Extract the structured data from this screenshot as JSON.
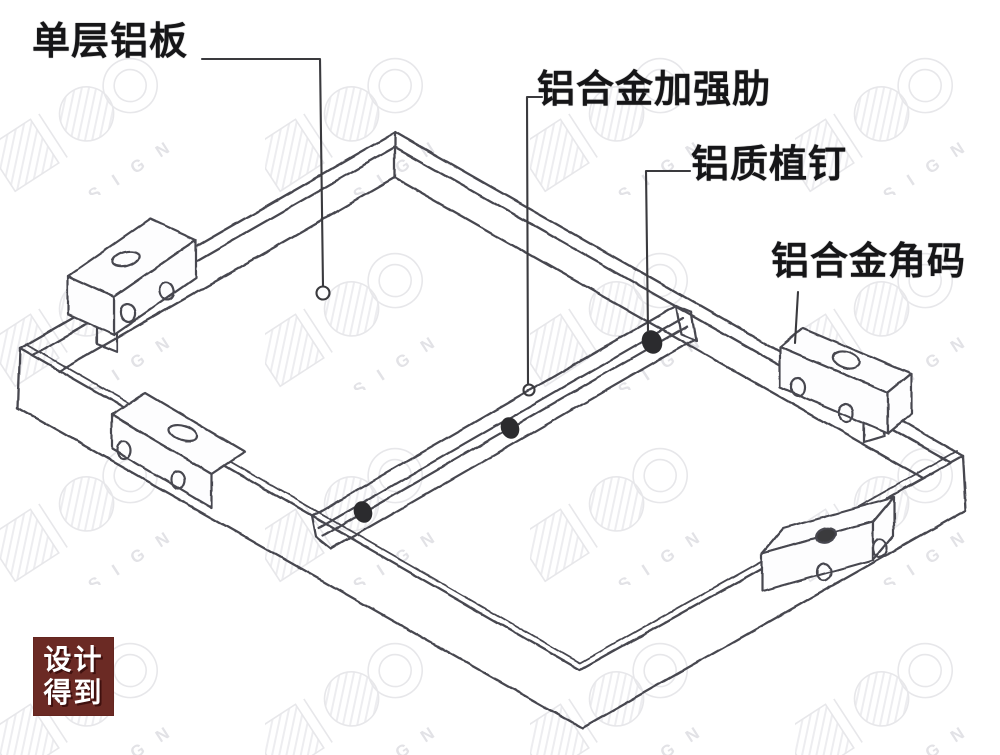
{
  "labels": [
    {
      "id": "single-layer-aluminum-panel",
      "text": "单层铝板"
    },
    {
      "id": "aluminum-alloy-stiffener-rib",
      "text": "铝合金加强肋"
    },
    {
      "id": "aluminum-stud",
      "text": "铝质植钉"
    },
    {
      "id": "aluminum-alloy-corner-bracket",
      "text": "铝合金角码"
    }
  ],
  "watermark": {
    "text": "DESIGN"
  },
  "logo": {
    "line1": "设计",
    "line2": "得到",
    "background": "#6B2A24",
    "text_color": "#FFFFFF"
  },
  "colors": {
    "background": "#FDFDFD",
    "sketch_line": "#474750",
    "leader_line": "#3A3A3E",
    "stud_fill": "#2B2B2E",
    "label_text": "#161618",
    "watermark_line": "#E7E7EA"
  }
}
